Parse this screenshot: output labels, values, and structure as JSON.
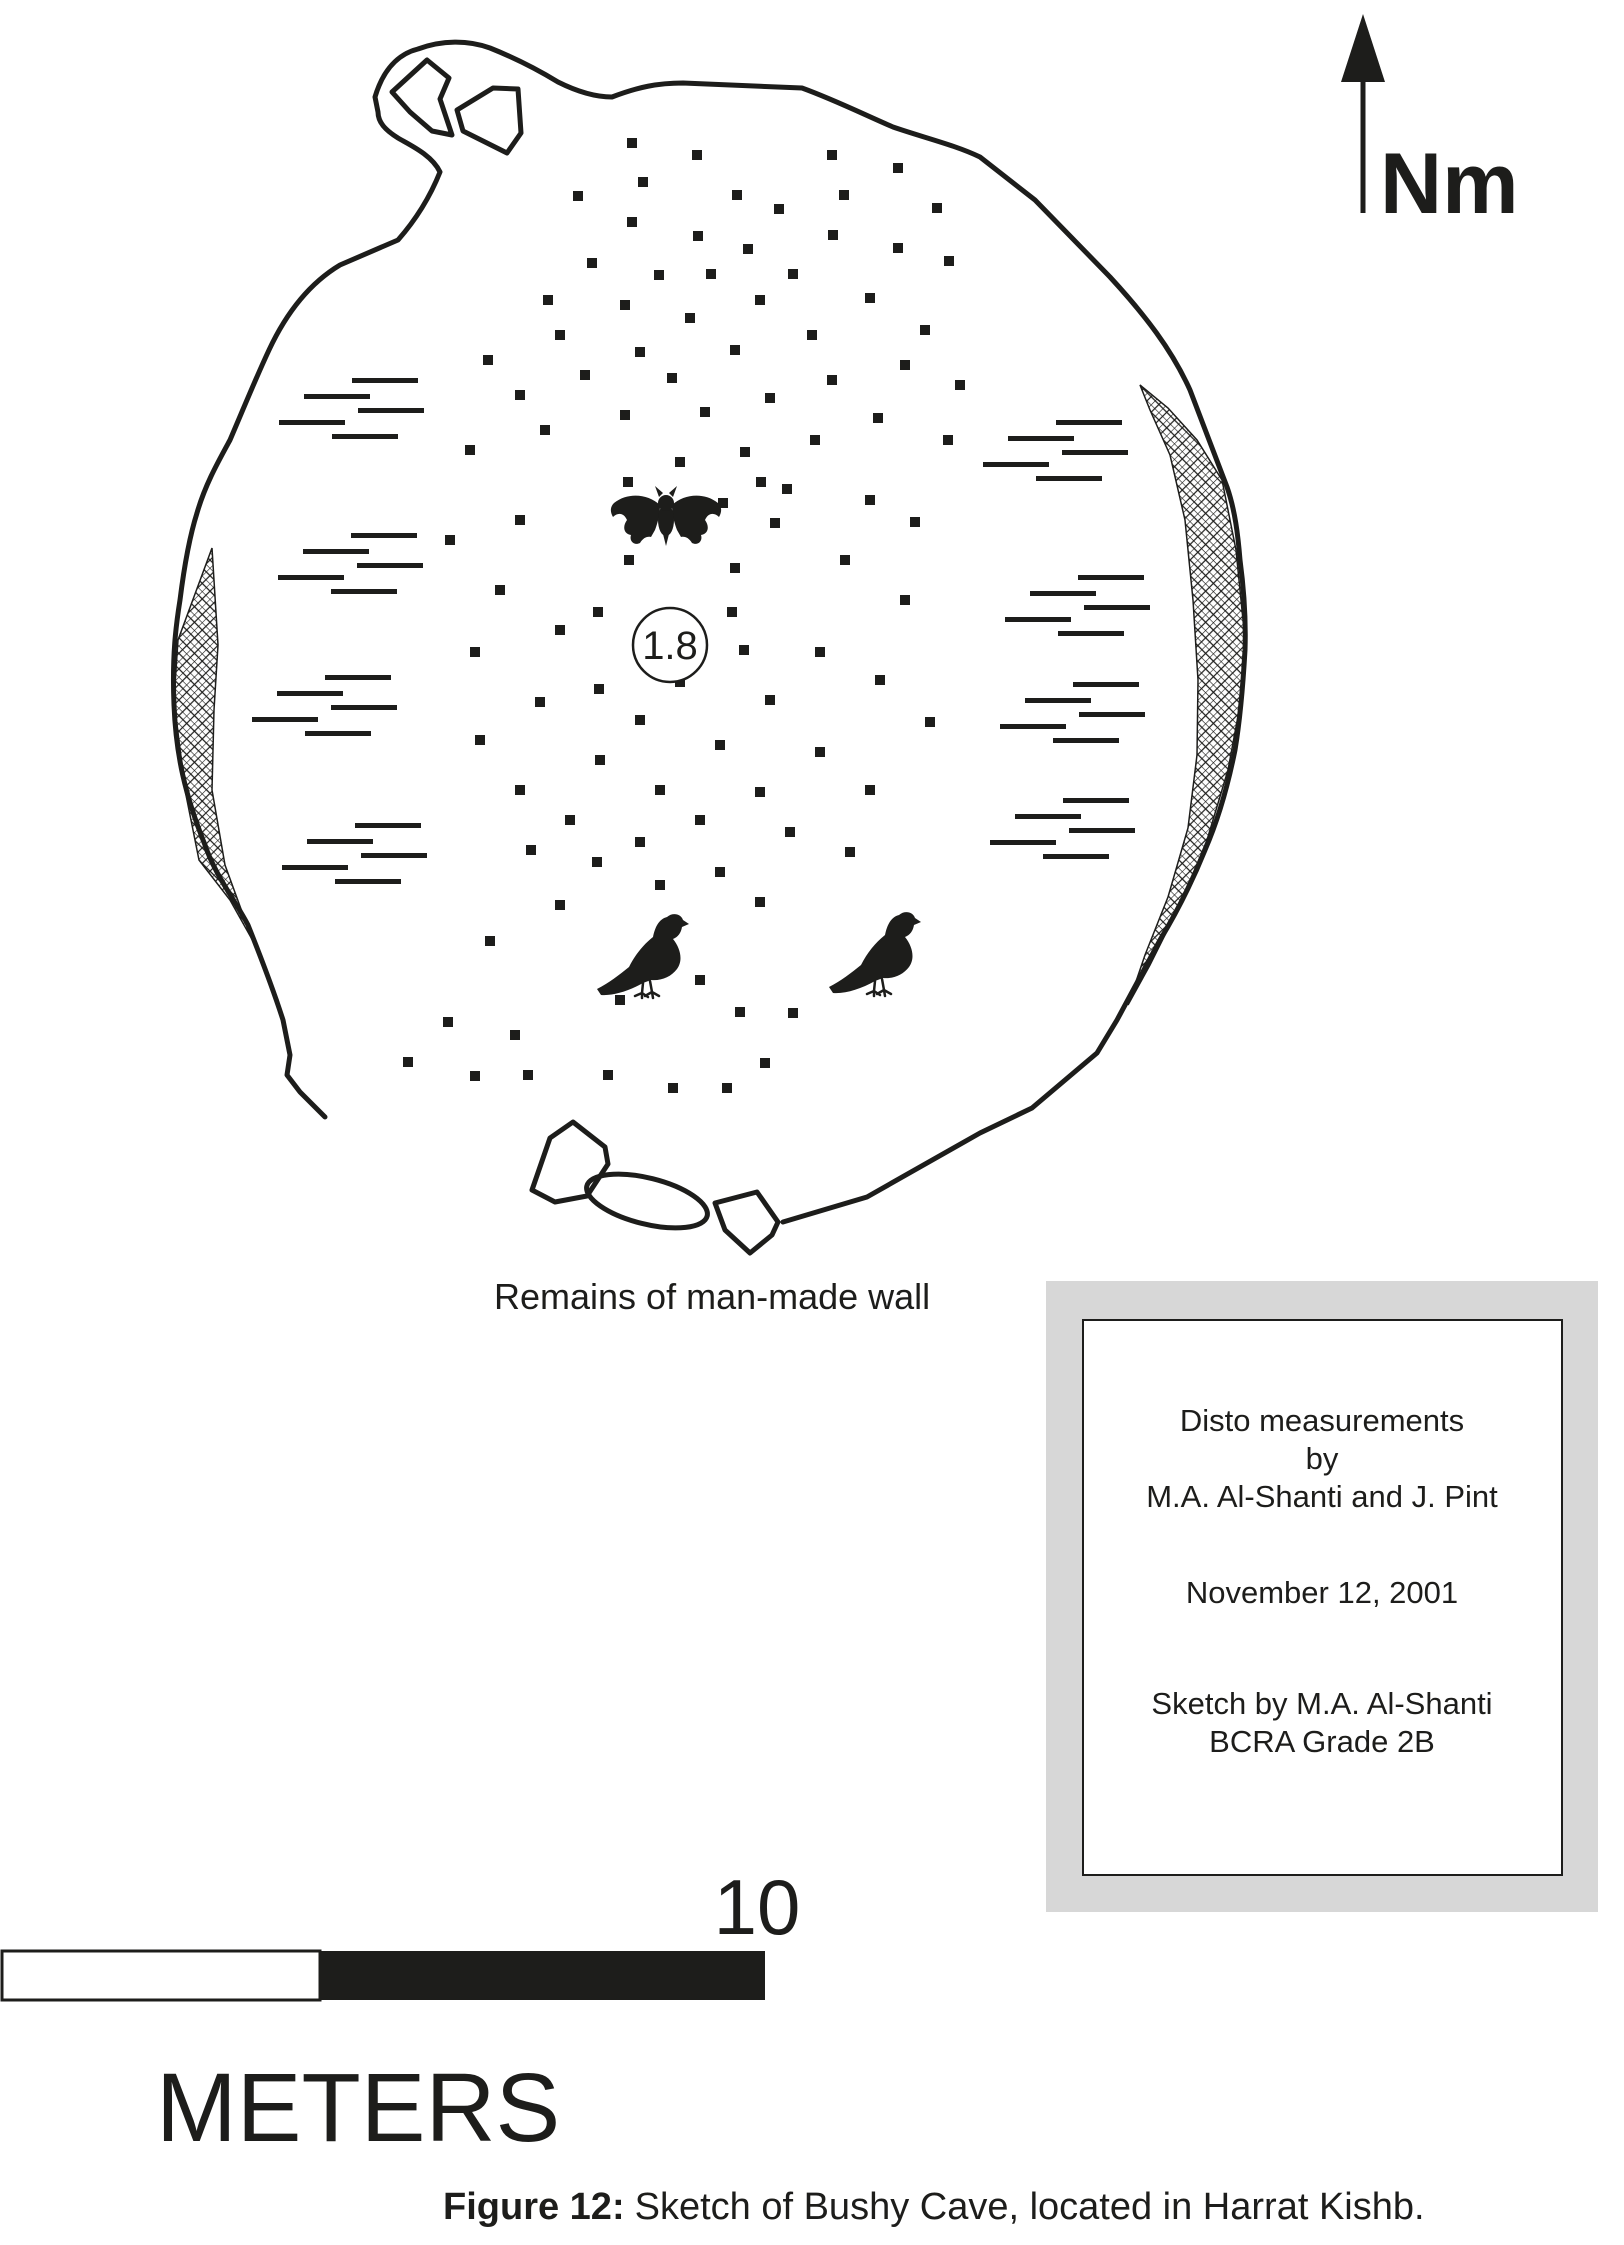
{
  "figure": {
    "north_label": "Nm",
    "ceiling_height": "1.8",
    "wall_label": "Remains of man-made wall",
    "caption_bold": "Figure 12:",
    "caption_rest": "Sketch of Bushy Cave, located in Harrat Kishb."
  },
  "scale_bar": {
    "value": "10",
    "unit": "METERS"
  },
  "info_box": {
    "lines": [
      "Disto measurements",
      "by",
      "M.A.  Al-Shanti and J. Pint",
      "November 12, 2001",
      "Sketch by M.A.  Al-Shanti",
      "BCRA Grade 2B"
    ]
  },
  "colors": {
    "ink": "#1d1d1b",
    "panel_gray": "#d7d7d7",
    "paper": "#ffffff"
  },
  "sketch": {
    "outline_path": "M325,1117 L300,1092 L287,1075 L290,1055 L283,1020 C275,995 260,955 248,925 C235,900 215,875 205,845 C185,795 176,755 174,705 C172,655 176,625 180,600 C185,560 190,535 197,513 C205,485 218,462 230,440 C245,405 255,380 269,350 C290,305 315,280 340,265 L398,240 C420,215 432,192 440,172 C432,155 410,145 398,138 C385,130 378,122 378,112 L375,97 C383,70 398,54 418,49 C442,40 468,40 490,48 C515,58 535,68 558,82 C578,92 595,97 612,97 C638,87 658,83 683,83 L802,88 C835,100 865,115 893,127 C925,138 955,145 980,157 L1035,200 L1110,277 C1145,315 1172,350 1190,390 L1227,487 C1235,510 1238,535 1240,560 C1244,590 1246,620 1245,650 C1243,685 1240,720 1235,750 C1228,785 1218,820 1205,850 C1192,882 1177,912 1160,940 L1117,1020 L1097,1053 L1032,1108 L980,1133 L867,1197 L783,1222",
    "left_hatch_path": "M212,548 L178,640 L174,700 L185,790 L199,860 L230,900 L258,950 L278,1000 L283,1020 L265,965 L245,920 L225,865 L212,790 L214,710 L218,645 Z",
    "right_hatch_path": "M1140,385 L1168,408 L1197,440 L1222,480 L1236,550 L1245,640 L1241,700 L1228,770 L1207,840 L1180,905 L1150,965 L1128,1005 L1145,955 L1168,897 L1188,828 L1197,755 L1198,680 L1193,600 L1185,520 L1170,455 L1150,410 Z",
    "upper_rock1_path": "M392,92 L427,60 L449,78 L440,99 L452,135 L432,131 L410,112 Z",
    "upper_rock2_path": "M457,110 L493,88 L518,89 L521,133 L507,153 L463,131 Z",
    "lower_rock1_path": "M573,1122 L550,1138 L532,1190 L555,1202 L587,1196 L608,1164 L605,1147 Z",
    "lower_rock2_path": "M715,1203 L725,1230 L750,1253 L772,1235 L778,1222 L757,1192 Z",
    "dots": [
      [
        632,
        143
      ],
      [
        697,
        155
      ],
      [
        832,
        155
      ],
      [
        898,
        168
      ],
      [
        643,
        182
      ],
      [
        578,
        196
      ],
      [
        737,
        195
      ],
      [
        844,
        195
      ],
      [
        779,
        209
      ],
      [
        937,
        208
      ],
      [
        632,
        222
      ],
      [
        698,
        236
      ],
      [
        833,
        235
      ],
      [
        748,
        249
      ],
      [
        898,
        248
      ],
      [
        592,
        263
      ],
      [
        949,
        261
      ],
      [
        659,
        275
      ],
      [
        711,
        274
      ],
      [
        793,
        274
      ],
      [
        548,
        300
      ],
      [
        625,
        305
      ],
      [
        760,
        300
      ],
      [
        870,
        298
      ],
      [
        690,
        318
      ],
      [
        925,
        330
      ],
      [
        560,
        335
      ],
      [
        812,
        335
      ],
      [
        640,
        352
      ],
      [
        735,
        350
      ],
      [
        488,
        360
      ],
      [
        905,
        365
      ],
      [
        585,
        375
      ],
      [
        672,
        378
      ],
      [
        832,
        380
      ],
      [
        960,
        385
      ],
      [
        520,
        395
      ],
      [
        770,
        398
      ],
      [
        705,
        412
      ],
      [
        625,
        415
      ],
      [
        878,
        418
      ],
      [
        545,
        430
      ],
      [
        948,
        440
      ],
      [
        815,
        440
      ],
      [
        470,
        450
      ],
      [
        745,
        452
      ],
      [
        680,
        462
      ],
      [
        628,
        482
      ],
      [
        761,
        482
      ],
      [
        787,
        489
      ],
      [
        723,
        503
      ],
      [
        870,
        500
      ],
      [
        915,
        522
      ],
      [
        775,
        523
      ],
      [
        520,
        520
      ],
      [
        450,
        540
      ],
      [
        629,
        560
      ],
      [
        735,
        568
      ],
      [
        845,
        560
      ],
      [
        500,
        590
      ],
      [
        598,
        612
      ],
      [
        732,
        612
      ],
      [
        905,
        600
      ],
      [
        560,
        630
      ],
      [
        744,
        650
      ],
      [
        820,
        652
      ],
      [
        599,
        689
      ],
      [
        680,
        682
      ],
      [
        880,
        680
      ],
      [
        475,
        652
      ],
      [
        770,
        700
      ],
      [
        640,
        720
      ],
      [
        540,
        702
      ],
      [
        930,
        722
      ],
      [
        480,
        740
      ],
      [
        720,
        745
      ],
      [
        820,
        752
      ],
      [
        600,
        760
      ],
      [
        520,
        790
      ],
      [
        660,
        790
      ],
      [
        760,
        792
      ],
      [
        870,
        790
      ],
      [
        570,
        820
      ],
      [
        700,
        820
      ],
      [
        640,
        842
      ],
      [
        790,
        832
      ],
      [
        850,
        852
      ],
      [
        531,
        850
      ],
      [
        597,
        862
      ],
      [
        720,
        872
      ],
      [
        660,
        885
      ],
      [
        560,
        905
      ],
      [
        490,
        941
      ],
      [
        760,
        902
      ],
      [
        620,
        1000
      ],
      [
        700,
        980
      ],
      [
        740,
        1012
      ],
      [
        793,
        1013
      ],
      [
        448,
        1022
      ],
      [
        515,
        1035
      ],
      [
        408,
        1062
      ],
      [
        475,
        1076
      ],
      [
        528,
        1075
      ],
      [
        608,
        1075
      ],
      [
        673,
        1088
      ],
      [
        727,
        1088
      ],
      [
        765,
        1063
      ]
    ],
    "ledge_clusters": [
      [
        279,
        378
      ],
      [
        278,
        533
      ],
      [
        252,
        675
      ],
      [
        282,
        823
      ],
      [
        983,
        420
      ],
      [
        1005,
        575
      ],
      [
        1000,
        682
      ],
      [
        990,
        798
      ]
    ],
    "ledge_pattern": [
      [
        73,
        0
      ],
      [
        25,
        16
      ],
      [
        79,
        30
      ],
      [
        0,
        42
      ],
      [
        53,
        56
      ]
    ],
    "ledge_line": {
      "w": 66,
      "h": 5
    },
    "bats": [
      [
        610,
        486
      ]
    ],
    "birds": [
      [
        597,
        911
      ],
      [
        829,
        909
      ]
    ]
  }
}
